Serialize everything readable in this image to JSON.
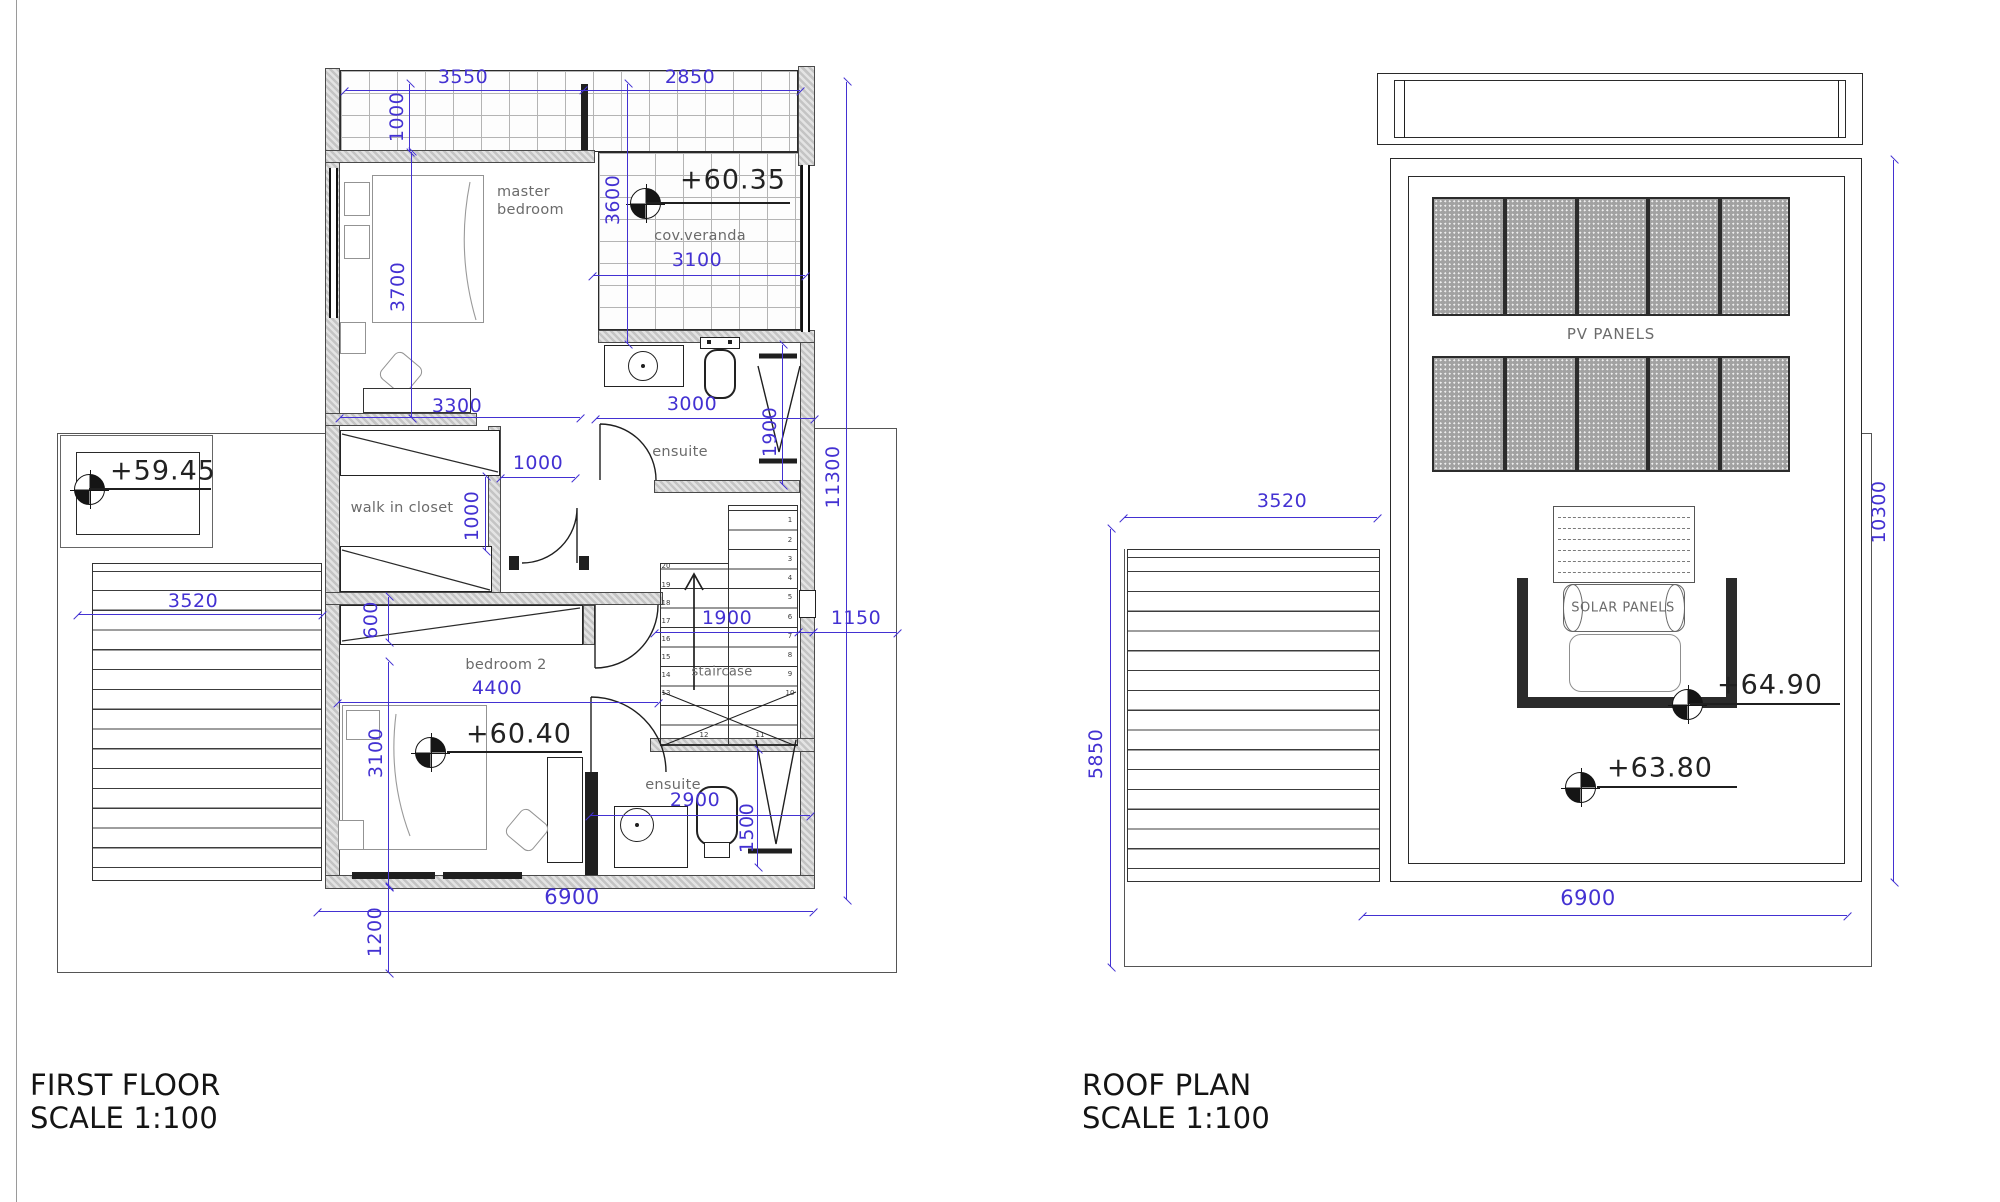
{
  "sheet": {
    "background": "#ffffff"
  },
  "colors": {
    "dimension": "#4331d2",
    "ink": "#1f1f1f",
    "wall_hatch": "#c4c4c4",
    "room_label": "#6b6b6b"
  },
  "first_floor": {
    "title": "FIRST FLOOR",
    "scale": "SCALE 1:100",
    "labels": {
      "master_bedroom_line1": "master",
      "master_bedroom_line2": "bedroom",
      "cov_veranda": "cov.veranda",
      "ensuite_top": "ensuite",
      "walk_in_closet": "walk in closet",
      "bedroom2": "bedroom 2",
      "staircase": "staircase",
      "ensuite_bottom": "ensuite"
    },
    "levels": {
      "veranda": "+60.35",
      "terrace": "+59.45",
      "bedroom": "+60.40"
    },
    "dims": {
      "top_left": "3550",
      "top_right": "2850",
      "veranda_height": "1000",
      "veranda_depth": "3600",
      "veranda_width": "3100",
      "master_height": "3700",
      "master_width": "3300",
      "ensuite_width": "3000",
      "shower_len": "1900",
      "total_height": "11300",
      "closet_opening": "1000",
      "closet_depth": "1000",
      "wardrobe_depth": "600",
      "stair_width": "1900",
      "side_gap": "1150",
      "bedroom2_width": "4400",
      "bedroom2_height": "3100",
      "ensuite2_width": "2900",
      "shower2_len": "1500",
      "total_width": "6900",
      "bottom_offset": "1200",
      "pergola_width": "3520"
    },
    "stairs": {
      "left_numbers": [
        "20",
        "19",
        "18",
        "17",
        "16",
        "15",
        "14",
        "13"
      ],
      "right_numbers": [
        "1",
        "2",
        "3",
        "4",
        "5",
        "6",
        "7",
        "8",
        "9",
        "10"
      ],
      "bottom_numbers": [
        "12",
        "11"
      ]
    }
  },
  "roof": {
    "title": "ROOF PLAN",
    "scale": "SCALE 1:100",
    "labels": {
      "pv_panels": "PV PANELS",
      "solar_panels": "SOLAR PANELS"
    },
    "levels": {
      "support": "+64.90",
      "roof_deck": "+63.80"
    },
    "dims": {
      "pergola_width": "3520",
      "pergola_height": "5850",
      "roof_height": "10300",
      "roof_width": "6900"
    }
  }
}
